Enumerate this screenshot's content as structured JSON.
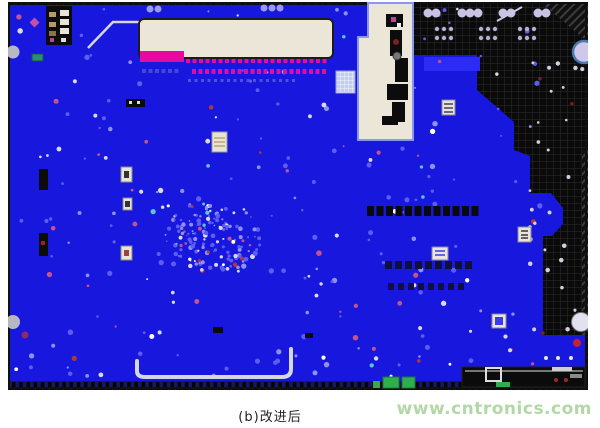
{
  "figure": {
    "caption": "(b)改进后"
  },
  "watermark": {
    "text": "www.cntronics.com"
  },
  "colors": {
    "page_bg": "#ffffff",
    "board_blue": "#1717dd",
    "bright_blue": "#2b2bf5",
    "dark_bg": "#0a0a0a",
    "grid_line": "#2d2d2d",
    "cream": "#ece6d8",
    "magenta": "#e60aa0",
    "lavender": "#c9c2e4",
    "green": "#2fae4e",
    "navy_strip": "#16166a",
    "trace": "#d6d6de",
    "caption": "#222222",
    "watermark": "#b2d8a8",
    "red_marker": "#c22233",
    "via_blue": "#5d5df2"
  },
  "texture": {
    "seed": 7,
    "cluster": {
      "cx": 213,
      "cy": 237,
      "r": 48,
      "count": 150
    },
    "scatter": {
      "count": 240,
      "x0": 14,
      "y0": 8,
      "x1": 540,
      "y1": 378
    },
    "black_scatter": {
      "count": 30,
      "x0": 528,
      "y0": 55,
      "x1": 583,
      "y1": 335
    },
    "palette": [
      [
        "#5d5df2",
        0.48
      ],
      [
        "#8f8ff7",
        0.18
      ],
      [
        "#d9d9ef",
        0.12
      ],
      [
        "#c4548a",
        0.09
      ],
      [
        "#b23737",
        0.05
      ],
      [
        "#58c8d8",
        0.04
      ],
      [
        "#ffffff",
        0.04
      ]
    ]
  }
}
